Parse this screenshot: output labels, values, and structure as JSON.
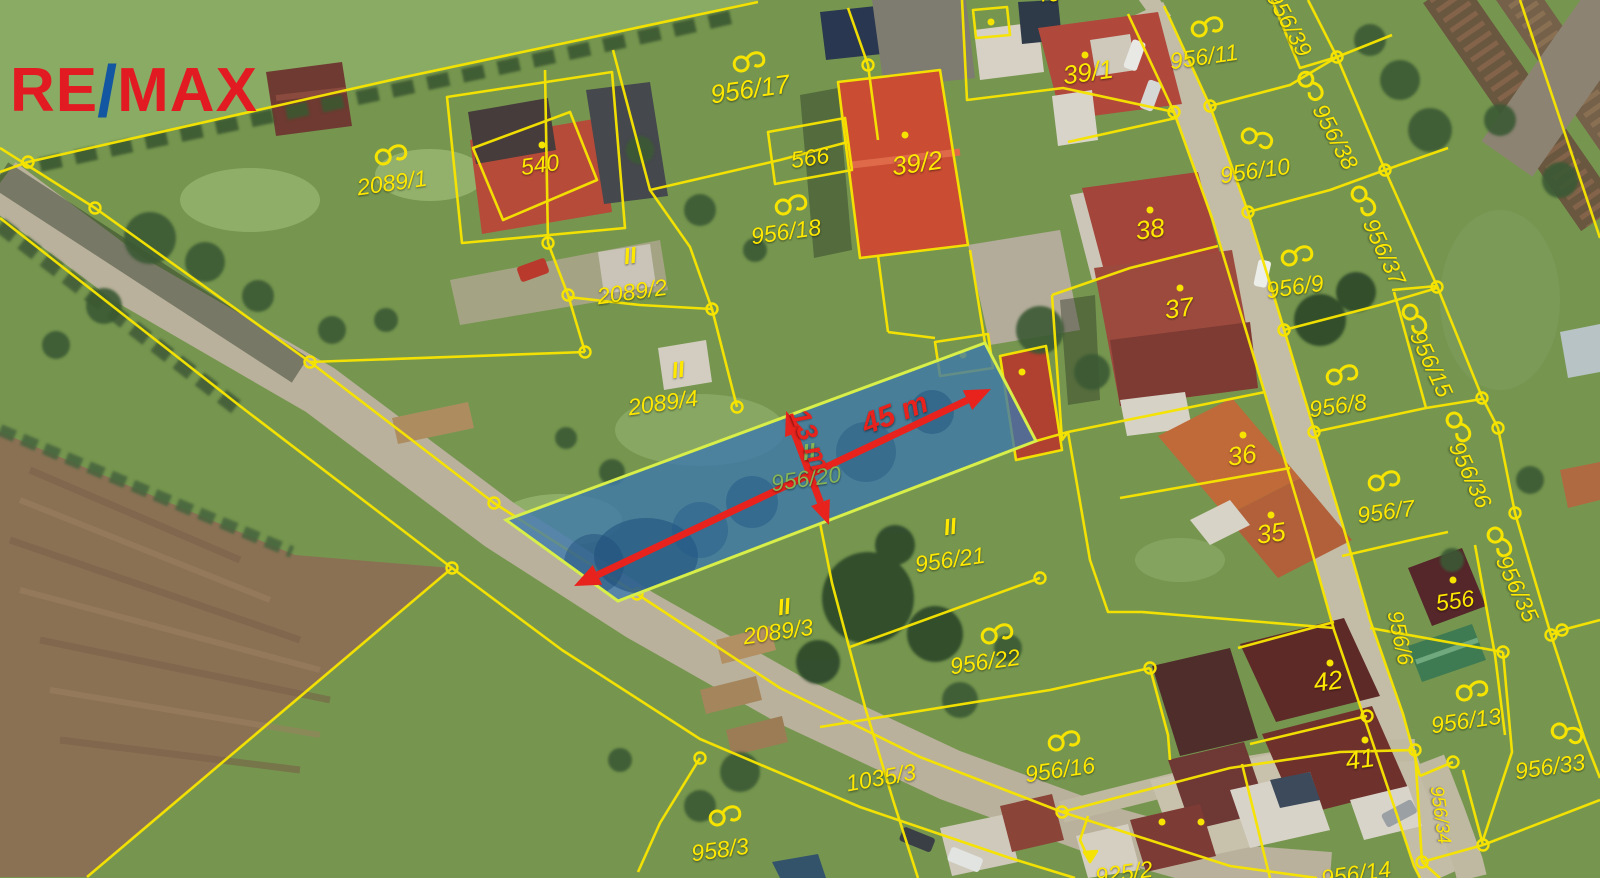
{
  "branding": {
    "re": "RE",
    "slash": "/",
    "max": "MAX"
  },
  "highlight": {
    "parcel": "956/20",
    "length_label": "45 m",
    "width_label": "13 m",
    "land_class_mark": "II"
  },
  "colors": {
    "label_yellow": "#ffe800",
    "highlight_label_green": "#86b457",
    "arrow_red": "#e8231d",
    "cadastral_line": "#f6e400",
    "highlight_fill": "#3b77ad",
    "highlight_stroke": "#d8ee49",
    "logo_red": "#e21b22",
    "logo_blue": "#1356a2"
  },
  "icons": {
    "parcel_symbol": "hook-circle-icon",
    "boundary_vertex": "circle-icon",
    "building_point": "dot-icon",
    "direction_hint": "bent-arrow-icon"
  },
  "map": {
    "label_color": "#ffe800",
    "label_fs": 23,
    "labels": [
      {
        "t": "2089/1",
        "x": 392,
        "y": 183,
        "r": -8
      },
      {
        "t": "540",
        "x": 540,
        "y": 165,
        "r": -8
      },
      {
        "t": "956/17",
        "x": 750,
        "y": 89,
        "r": -8,
        "fs": 26
      },
      {
        "t": "566",
        "x": 810,
        "y": 158,
        "r": -8
      },
      {
        "t": "39/2",
        "x": 917,
        "y": 163,
        "r": -8,
        "fs": 26
      },
      {
        "t": "956/18",
        "x": 786,
        "y": 232,
        "r": -8
      },
      {
        "t": "40",
        "x": 1048,
        "y": -6,
        "r": 0
      },
      {
        "t": "39/1",
        "x": 1088,
        "y": 72,
        "r": -8,
        "fs": 26
      },
      {
        "t": "956/11",
        "x": 1204,
        "y": 57,
        "r": -8
      },
      {
        "t": "956/39",
        "x": 1289,
        "y": 24,
        "r": 62
      },
      {
        "t": "956/10",
        "x": 1255,
        "y": 171,
        "r": -8
      },
      {
        "t": "956/38",
        "x": 1335,
        "y": 137,
        "r": 62
      },
      {
        "t": "38",
        "x": 1150,
        "y": 229,
        "r": -8,
        "fs": 26
      },
      {
        "t": "37",
        "x": 1179,
        "y": 308,
        "r": -8,
        "fs": 26
      },
      {
        "t": "956/9",
        "x": 1295,
        "y": 287,
        "r": -8
      },
      {
        "t": "956/37",
        "x": 1384,
        "y": 252,
        "r": 65
      },
      {
        "t": "956/15",
        "x": 1431,
        "y": 364,
        "r": 65
      },
      {
        "t": "956/8",
        "x": 1338,
        "y": 406,
        "r": -8
      },
      {
        "t": "36",
        "x": 1242,
        "y": 455,
        "r": -8,
        "fs": 26
      },
      {
        "t": "956/7",
        "x": 1386,
        "y": 512,
        "r": -8
      },
      {
        "t": "956/36",
        "x": 1470,
        "y": 475,
        "r": 65
      },
      {
        "t": "35",
        "x": 1271,
        "y": 533,
        "r": -8,
        "fs": 26
      },
      {
        "t": "556",
        "x": 1455,
        "y": 601,
        "r": -8
      },
      {
        "t": "956/35",
        "x": 1517,
        "y": 589,
        "r": 65
      },
      {
        "t": "956/6",
        "x": 1400,
        "y": 638,
        "r": 78,
        "fs": 22
      },
      {
        "t": "42",
        "x": 1328,
        "y": 681,
        "r": -8,
        "fs": 26
      },
      {
        "t": "956/13",
        "x": 1466,
        "y": 721,
        "r": -8
      },
      {
        "t": "41",
        "x": 1360,
        "y": 759,
        "r": -8,
        "fs": 26
      },
      {
        "t": "956/33",
        "x": 1550,
        "y": 767,
        "r": -8
      },
      {
        "t": "956/34",
        "x": 1440,
        "y": 815,
        "r": 82,
        "fs": 19
      },
      {
        "t": "956/14",
        "x": 1356,
        "y": 874,
        "r": -8
      },
      {
        "t": "925/2",
        "x": 1124,
        "y": 873,
        "r": -8
      },
      {
        "t": "956/16",
        "x": 1060,
        "y": 770,
        "r": -8
      },
      {
        "t": "956/22",
        "x": 985,
        "y": 662,
        "r": -8
      },
      {
        "t": "956/21",
        "x": 950,
        "y": 560,
        "r": -8
      },
      {
        "t": "II",
        "x": 950,
        "y": 527,
        "r": -8,
        "b": true
      },
      {
        "t": "2089/3",
        "x": 778,
        "y": 632,
        "r": -8
      },
      {
        "t": "II",
        "x": 784,
        "y": 607,
        "r": -8,
        "b": true
      },
      {
        "t": "2089/4",
        "x": 663,
        "y": 403,
        "r": -8
      },
      {
        "t": "II",
        "x": 678,
        "y": 370,
        "r": -8,
        "b": true
      },
      {
        "t": "2089/2",
        "x": 632,
        "y": 292,
        "r": -8
      },
      {
        "t": "II",
        "x": 630,
        "y": 256,
        "r": -8,
        "b": true
      },
      {
        "t": "958/3",
        "x": 720,
        "y": 850,
        "r": -8
      },
      {
        "t": "1035/3",
        "x": 881,
        "y": 778,
        "r": -10
      },
      {
        "t": "956/20",
        "x": 806,
        "y": 479,
        "r": -8,
        "c": "#86b457"
      },
      {
        "t": "II",
        "x": 809,
        "y": 452,
        "r": -8,
        "b": true,
        "c": "#86b457"
      },
      {
        "t": "45 m",
        "x": 895,
        "y": 414,
        "r": -21,
        "c": "#e8231d",
        "b": true,
        "fs": 30,
        "ni": true
      },
      {
        "t": "13 m",
        "x": 810,
        "y": 440,
        "r": 68,
        "c": "#e8231d",
        "b": true,
        "fs": 28,
        "ni": true
      }
    ]
  }
}
